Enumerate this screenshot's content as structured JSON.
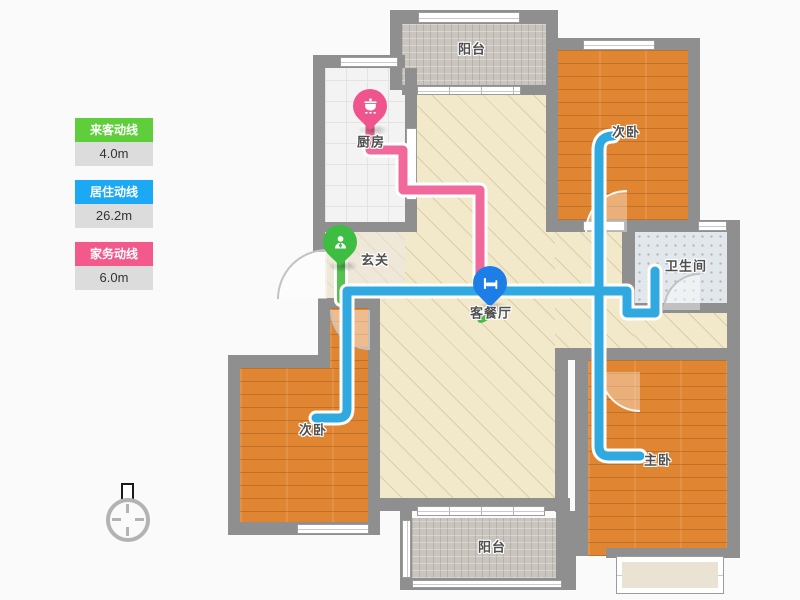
{
  "legend": {
    "items": [
      {
        "label": "来客动线",
        "value": "4.0m",
        "color": "#5ecf3a"
      },
      {
        "label": "居住动线",
        "value": "26.2m",
        "color": "#1ba9f5"
      },
      {
        "label": "家务动线",
        "value": "6.0m",
        "color": "#f4598c"
      }
    ]
  },
  "floorplan": {
    "rooms": [
      {
        "id": "balcony-top",
        "label": "阳台"
      },
      {
        "id": "bedroom-top-right",
        "label": "次卧"
      },
      {
        "id": "kitchen",
        "label": "厨房"
      },
      {
        "id": "entry",
        "label": "玄关"
      },
      {
        "id": "living-dining",
        "label": "客餐厅"
      },
      {
        "id": "bathroom",
        "label": "卫生间"
      },
      {
        "id": "bedroom-left",
        "label": "次卧"
      },
      {
        "id": "bedroom-master",
        "label": "主卧"
      },
      {
        "id": "balcony-bottom",
        "label": "阳台"
      }
    ],
    "pins": [
      {
        "room": "kitchen",
        "icon": "pot-icon",
        "color": "#f0548c"
      },
      {
        "room": "entry",
        "icon": "person-icon",
        "color": "#3dbd41"
      },
      {
        "room": "living-dining",
        "icon": "bed-icon",
        "color": "#1e7ee8"
      }
    ],
    "lines": {
      "visitor": {
        "label": "来客动线",
        "length": "4.0m",
        "color": "#55c14f"
      },
      "living": {
        "label": "居住动线",
        "length": "26.2m",
        "color": "#2fa9df"
      },
      "housework": {
        "label": "家务动线",
        "length": "6.0m",
        "color": "#f0699a"
      }
    },
    "compass": {
      "type": "north-indicator"
    }
  }
}
